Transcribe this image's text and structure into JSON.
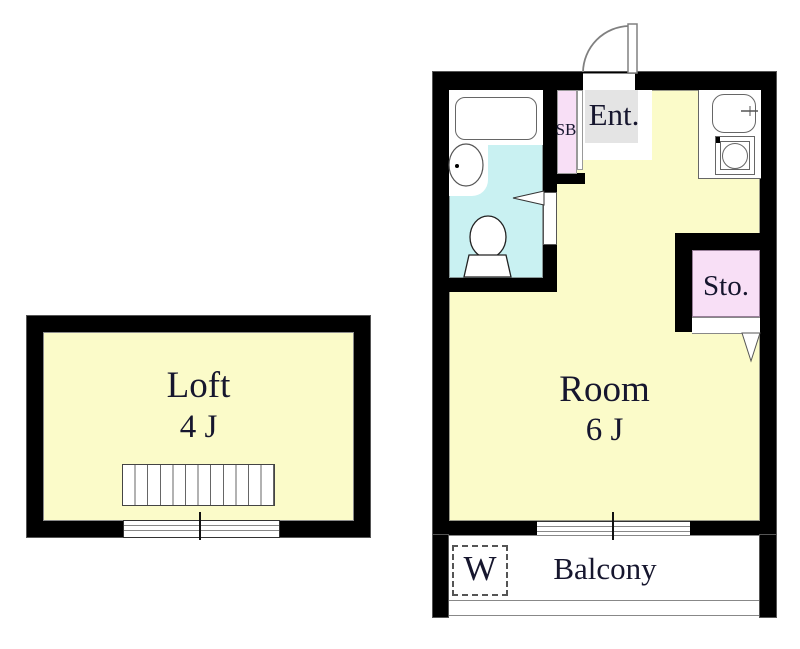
{
  "floorplan": {
    "loft_unit": {
      "name": "Loft",
      "area": "4 J"
    },
    "main_unit": {
      "entrance": "Ent.",
      "shoe_box": "SB",
      "storage": "Sto.",
      "room_name": "Room",
      "room_area": "6 J",
      "washer": "W",
      "balcony": "Balcony"
    },
    "colors": {
      "room_fill": "#FBFBC9",
      "bath_fill": "#C9F1F2",
      "closet_fill": "#F8DFF6",
      "entry_fill": "#E4E4E4",
      "wall": "#000000",
      "fixture_line": "#666666",
      "door_line": "#808080"
    }
  }
}
